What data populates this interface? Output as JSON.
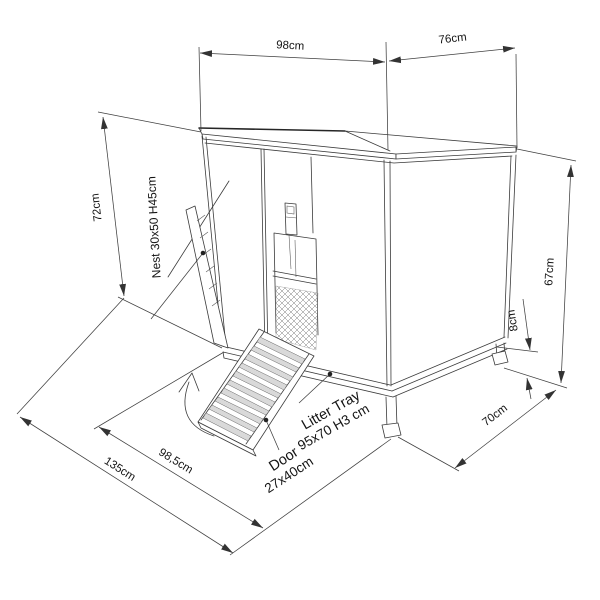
{
  "diagram": {
    "title": "pet-hutch-dimension-drawing",
    "colors": {
      "line": "#3b3b3b",
      "text": "#141414",
      "slat": "#d9d9d9",
      "background": "#ffffff"
    },
    "dims": {
      "roof_front_width": "98cm",
      "roof_side_depth": "76cm",
      "left_wall_height": "72cm",
      "right_frame_height": "67cm",
      "ground_clearance": "8cm",
      "base_depth": "70cm",
      "base_front_width": "98,5cm",
      "total_width": "135cm"
    },
    "labels": {
      "nest": "Nest 30x50 H45cm",
      "litter_tray_line1": "Litter Tray",
      "litter_tray_line2": "95x70 H3 cm",
      "door_line1": "Door",
      "door_line2": "27x40cm"
    }
  }
}
